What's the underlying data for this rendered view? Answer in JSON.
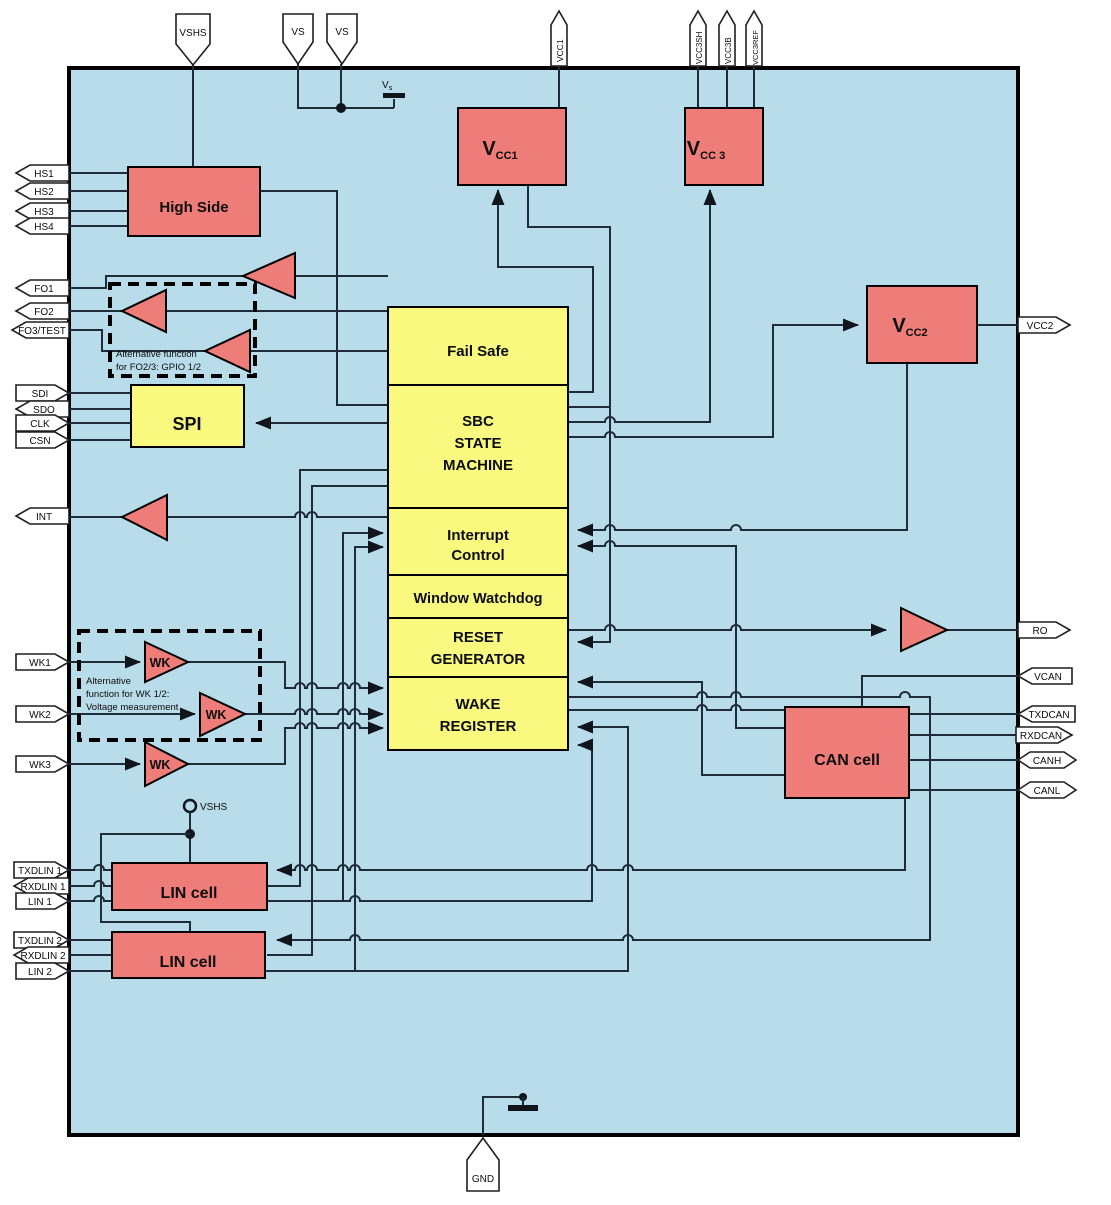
{
  "title": "SBC block diagram",
  "colors": {
    "chip_fill": "#b9dcea",
    "block_red": "#ee7d79",
    "block_yellow": "#f9f97f",
    "wire": "#1e2b38",
    "background": "#ffffff"
  },
  "blocks": {
    "high_side": "High Side",
    "vcc1": {
      "v": "V",
      "sub": "CC1"
    },
    "vcc3": {
      "v": "V",
      "sub": "CC 3"
    },
    "vcc2": {
      "v": "V",
      "sub": "CC2"
    },
    "spi": "SPI",
    "fail_safe": "Fail Safe",
    "sbc": {
      "l1": "SBC",
      "l2": "STATE",
      "l3": "MACHINE"
    },
    "interrupt": {
      "l1": "Interrupt",
      "l2": "Control"
    },
    "watchdog": "Window Watchdog",
    "reset": {
      "l1": "RESET",
      "l2": "GENERATOR"
    },
    "wake": {
      "l1": "WAKE",
      "l2": "REGISTER"
    },
    "can": "CAN cell",
    "lin1": "LIN cell",
    "lin2": "LIN cell",
    "wk": "WK"
  },
  "pins": {
    "top": [
      {
        "label": "VSHS"
      },
      {
        "label": "VS"
      },
      {
        "label": "VS"
      },
      {
        "label": "VCC1"
      },
      {
        "label": "VCC3SH"
      },
      {
        "label": "VCC3B"
      },
      {
        "label": "VCC3REF"
      }
    ],
    "left": [
      {
        "label": "HS1"
      },
      {
        "label": "HS2"
      },
      {
        "label": "HS3"
      },
      {
        "label": "HS4"
      },
      {
        "label": "FO1"
      },
      {
        "label": "FO2"
      },
      {
        "label": "FO3/TEST"
      },
      {
        "label": "SDI"
      },
      {
        "label": "SDO"
      },
      {
        "label": "CLK"
      },
      {
        "label": "CSN"
      },
      {
        "label": "INT"
      },
      {
        "label": "WK1"
      },
      {
        "label": "WK2"
      },
      {
        "label": "WK3"
      },
      {
        "label": "TXDLIN 1"
      },
      {
        "label": "RXDLIN 1"
      },
      {
        "label": "LIN 1"
      },
      {
        "label": "TXDLIN 2"
      },
      {
        "label": "RXDLIN 2"
      },
      {
        "label": "LIN 2"
      }
    ],
    "right": [
      {
        "label": "VCC2"
      },
      {
        "label": "RO"
      },
      {
        "label": "VCAN"
      },
      {
        "label": "TXDCAN"
      },
      {
        "label": "RXDCAN"
      },
      {
        "label": "CANH"
      },
      {
        "label": "CANL"
      }
    ],
    "bottom": [
      {
        "label": "GND"
      }
    ]
  },
  "notes": {
    "fo": {
      "l1": "Alternative function",
      "l2": "for FO2/3: GPIO 1/2"
    },
    "wk": {
      "l1": "Alternative",
      "l2": "function for WK 1/2:",
      "l3": "Voltage measurement"
    }
  },
  "labels": {
    "vs_battery": {
      "v": "V",
      "sub": "s"
    },
    "vshs_node": "VSHS"
  }
}
